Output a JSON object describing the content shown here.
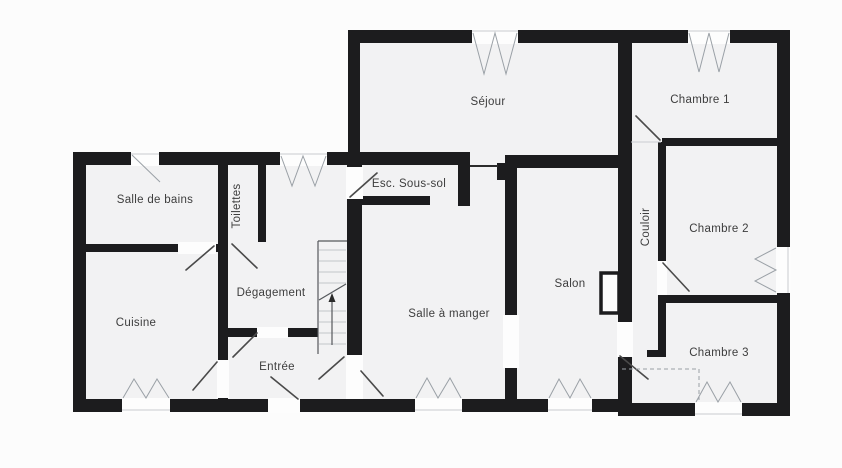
{
  "title": "Plan d'étage",
  "colors": {
    "background": "#fcfcfc",
    "room_fill": "#f2f2f3",
    "wall": "#1c1c1e",
    "opening": "#fdfdfd",
    "label": "#3d3d3d",
    "symbol": "#9aa0a6",
    "door": "#4a4a4a",
    "dashed": "#9aa0a6"
  },
  "rooms": {
    "salle_de_bains": "Salle de bains",
    "toilettes": "Toilettes",
    "degagement": "Dégagement",
    "cuisine": "Cuisine",
    "entree": "Entrée",
    "esc_sous_sol": "Esc. Sous-sol",
    "sejour": "Séjour",
    "salle_a_manger": "Salle à manger",
    "salon": "Salon",
    "chambre_1": "Chambre 1",
    "couloir": "Couloir",
    "chambre_2": "Chambre 2",
    "chambre_3": "Chambre 3"
  }
}
